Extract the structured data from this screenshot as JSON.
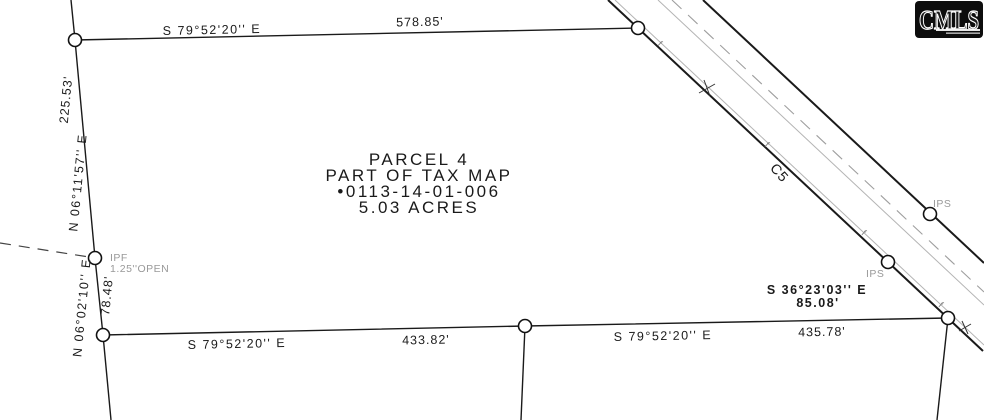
{
  "map": {
    "parcel": {
      "name": "PARCEL 4",
      "line2": "PART OF TAX MAP",
      "line3": "•0113-14-01-006",
      "line4": "5.03 ACRES"
    },
    "calls": {
      "top": {
        "bearing": "S 79°52'20'' E",
        "distance": "578.85'"
      },
      "left_upper": {
        "bearing": "N 06°11'57'' E",
        "distance": "225.53'"
      },
      "left_lower": {
        "bearing": "N 06°02'10'' E",
        "distance": "78.48'"
      },
      "bottom_west": {
        "bearing": "S 79°52'20'' E",
        "distance": "433.82'"
      },
      "bottom_east": {
        "bearing": "S 79°52'20'' E",
        "distance": "435.78'"
      },
      "road": {
        "bearing": "S 36°23'03'' E",
        "distance": "85.08'"
      }
    },
    "markers": {
      "ipf_label": "IPF",
      "ipf_note": "1.25''OPEN",
      "ips_a": "IPS",
      "ips_b": "IPS"
    },
    "road": {
      "curve_label": "C5"
    },
    "fence_tick": "f"
  },
  "logo": {
    "text": "CMLS"
  },
  "colors": {
    "ink": "#1a1a1a",
    "muted": "#999999",
    "road_thin": "#b4b4b4",
    "road_dash": "#9e9e9e",
    "logo_bg": "#0d0d0d"
  }
}
